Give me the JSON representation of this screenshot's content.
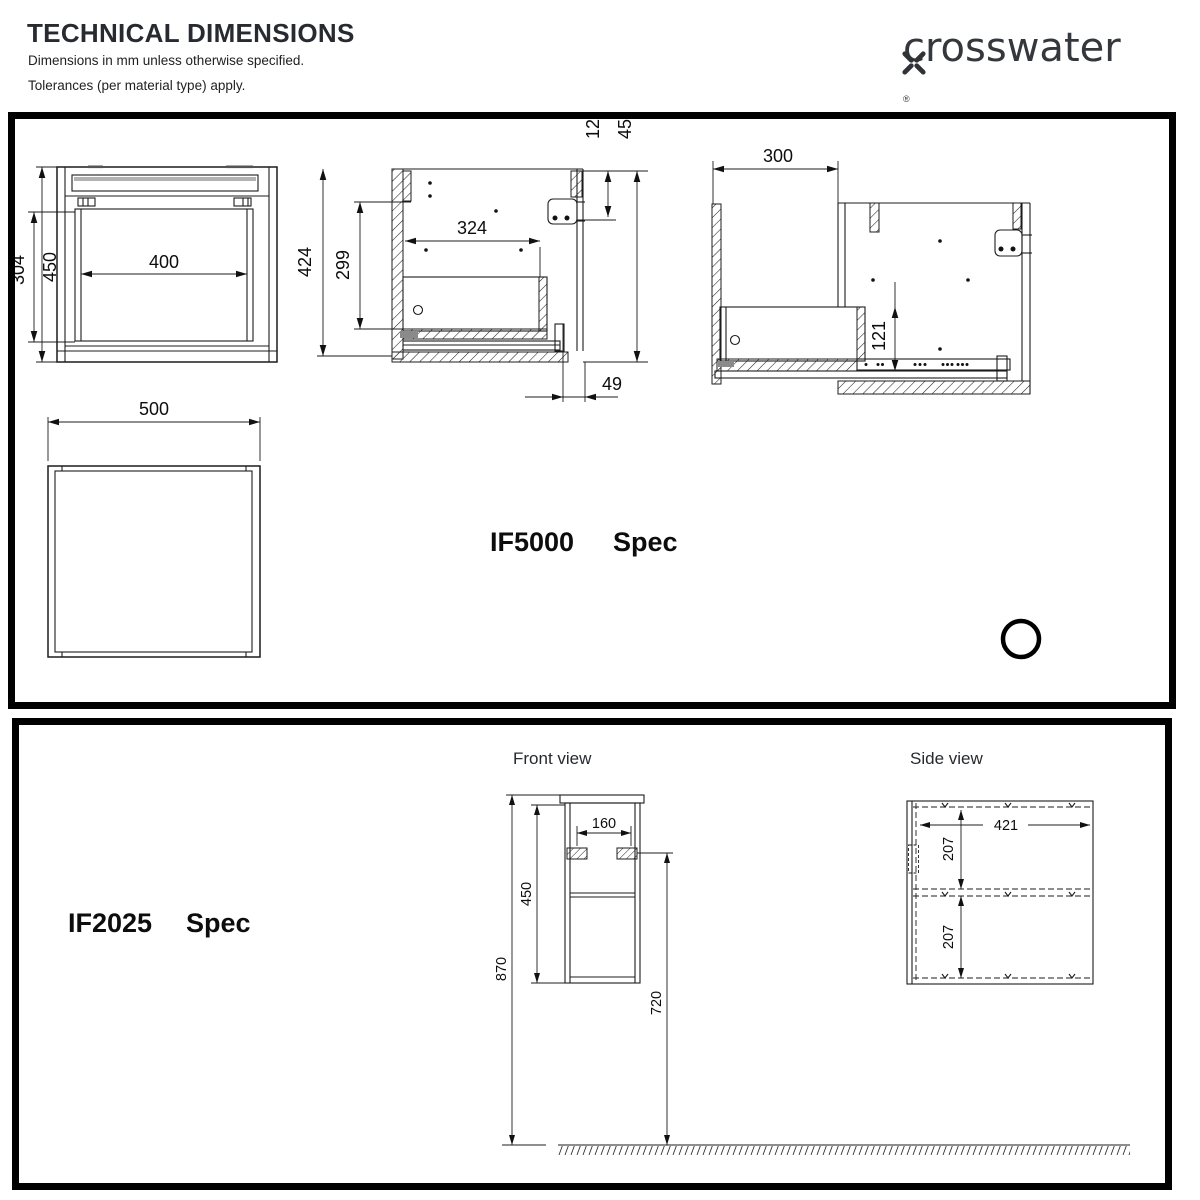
{
  "header": {
    "title": "TECHNICAL DIMENSIONS",
    "subtitle1": "Dimensions in mm unless otherwise specified.",
    "subtitle2": "Tolerances (per material type) apply.",
    "brand": "crosswater",
    "reg": "®"
  },
  "if5000": {
    "name": "IF5000",
    "spec": "Spec",
    "front": {
      "w400": "400",
      "h304": "304",
      "h450": "450"
    },
    "section": {
      "h424": "424",
      "h299": "299",
      "w324": "324",
      "d120": "120",
      "h450": "450",
      "d49": "49"
    },
    "extended": {
      "d300": "300",
      "d121": "121"
    },
    "plan": {
      "w500": "500"
    }
  },
  "if2025": {
    "name": "IF2025",
    "spec": "Spec",
    "front": {
      "title": "Front view",
      "w160": "160",
      "h450": "450",
      "h870": "870",
      "h720": "720"
    },
    "side": {
      "title": "Side view",
      "d421": "421",
      "s207a": "207",
      "s207b": "207"
    }
  }
}
